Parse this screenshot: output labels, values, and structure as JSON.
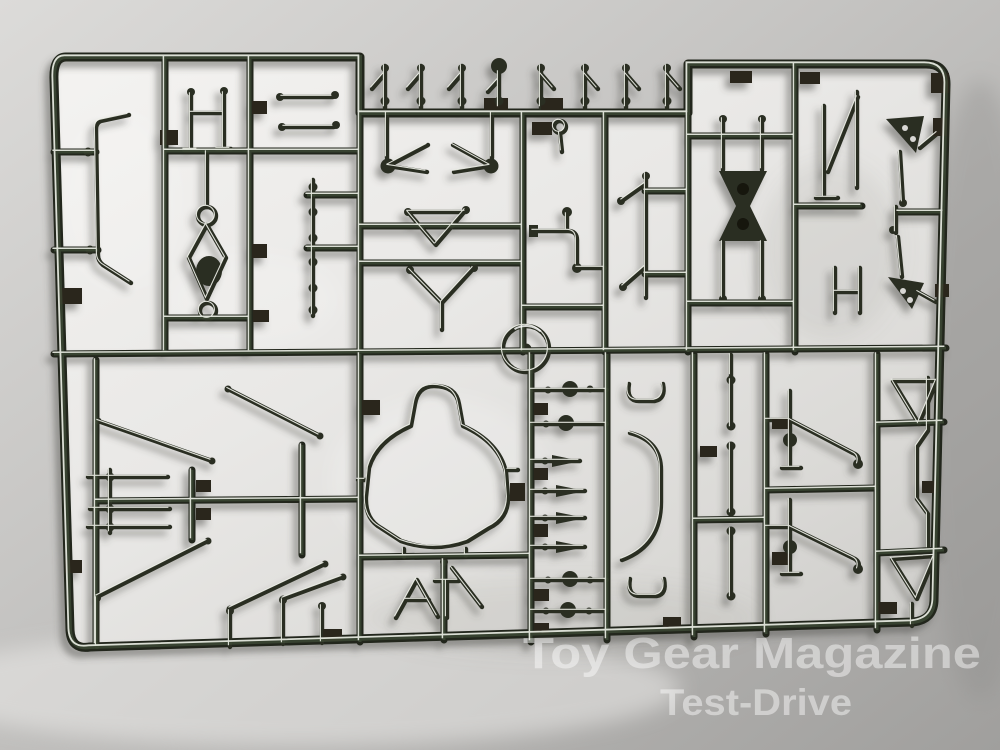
{
  "photo": {
    "subject": "Chrome-plated model car kit sprue (parts tree) lying on white paper",
    "scene": "Dark chromed plastic runner frame divided into rectangular cells, each holding small chrome parts; soft studio shadows fall down-left on the paper",
    "parts_inventory": [
      "anti-roll bar",
      "suspension wishbones",
      "tie rods",
      "drive shaft",
      "differential housing",
      "steering wheel ring",
      "shift levers",
      "chassis bulkhead frame",
      "roll-over hoop",
      "intake cones",
      "axle bars",
      "brake caliper uprights",
      "triangular braces"
    ]
  },
  "watermark": {
    "line1": "Toy Gear Magazine",
    "line2": "Test-Drive"
  },
  "palette": {
    "paper_light": "#f3f2f0",
    "paper_mid": "#c6c5c3",
    "paper_dark": "#9e9d9b",
    "runner_dark": "#20251b",
    "runner_green_tint": "#4d5f45",
    "chrome_glint": "#edf0e7",
    "watermark_text": "rgba(255,255,255,0.45)"
  }
}
